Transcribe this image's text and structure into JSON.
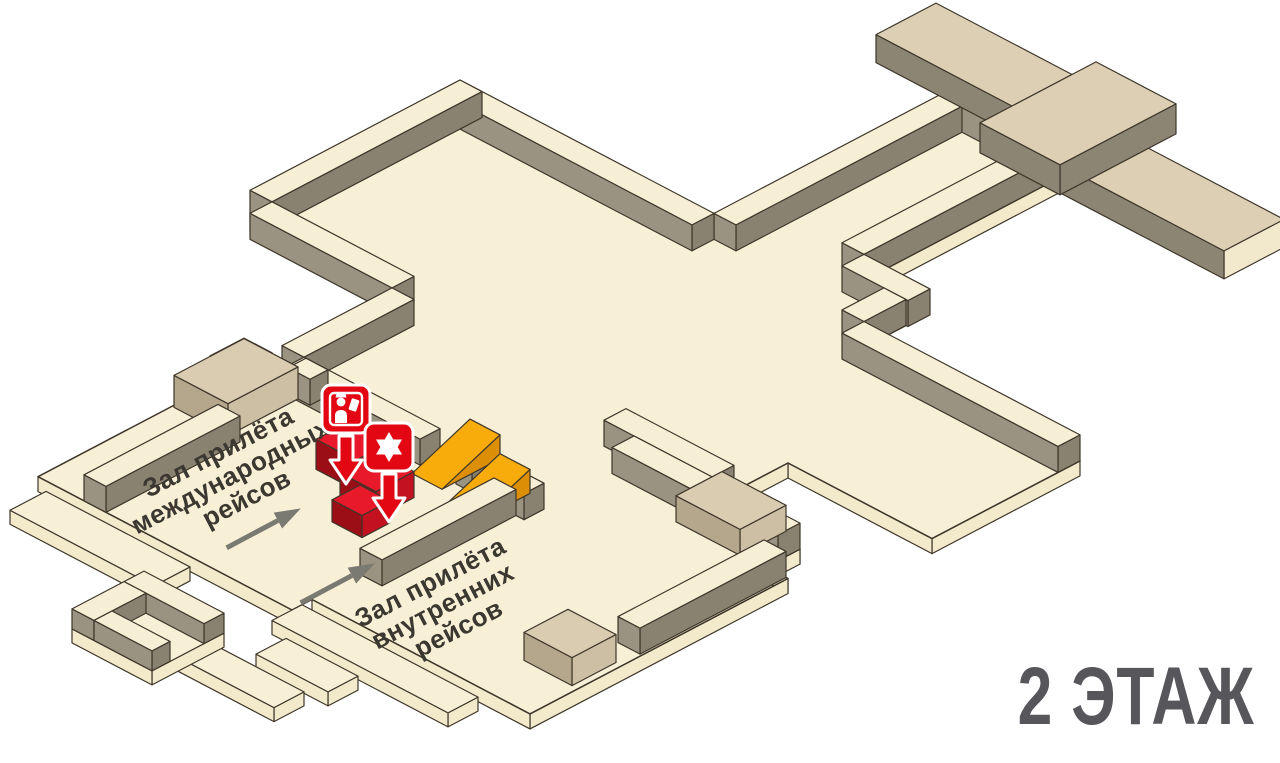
{
  "floor_badge": {
    "text": "2 ЭТАЖ"
  },
  "halls": [
    {
      "id": "international-arrivals",
      "lines": [
        "Зал прилёта",
        "международных",
        "рейсов"
      ]
    },
    {
      "id": "domestic-arrivals",
      "lines": [
        "Зал прилёта",
        "внутренних",
        "рейсов"
      ]
    }
  ],
  "markers": [
    {
      "id": "passport-control",
      "icon": "passport-control-icon"
    },
    {
      "id": "police-post",
      "icon": "six-pointed-star-icon"
    }
  ],
  "arrows": [
    {
      "id": "international-flow-arrow"
    },
    {
      "id": "domestic-flow-arrow"
    }
  ],
  "colors": {
    "outline": "#3E362A",
    "floor_top": "#F8F0D6",
    "floor_side": "#F3EACB",
    "wall_top": "#F7EFD5",
    "wall_face_se": "#8A8270",
    "wall_face_sw": "#9B9381",
    "gallery_top": "#DCCFB4",
    "gallery_side_gray": "#8D8574",
    "gallery_end_cream": "#F2E9CD",
    "kiosk_top": "#D9CCB1",
    "kiosk_face_se": "#CDBFA4",
    "kiosk_face_sw": "#B5A78C",
    "block_top": "#E8192B",
    "block_face_se": "#C41120",
    "block_face_sw": "#9B0E16",
    "marker_red": "#E30613",
    "ramp_top": "#F7AC0B",
    "ramp_side": "#DB8E06",
    "arrow_gray": "#7B7A72",
    "label_text": "#3B3731",
    "floor_label_text": "#57565A",
    "background": "#FFFFFF"
  }
}
